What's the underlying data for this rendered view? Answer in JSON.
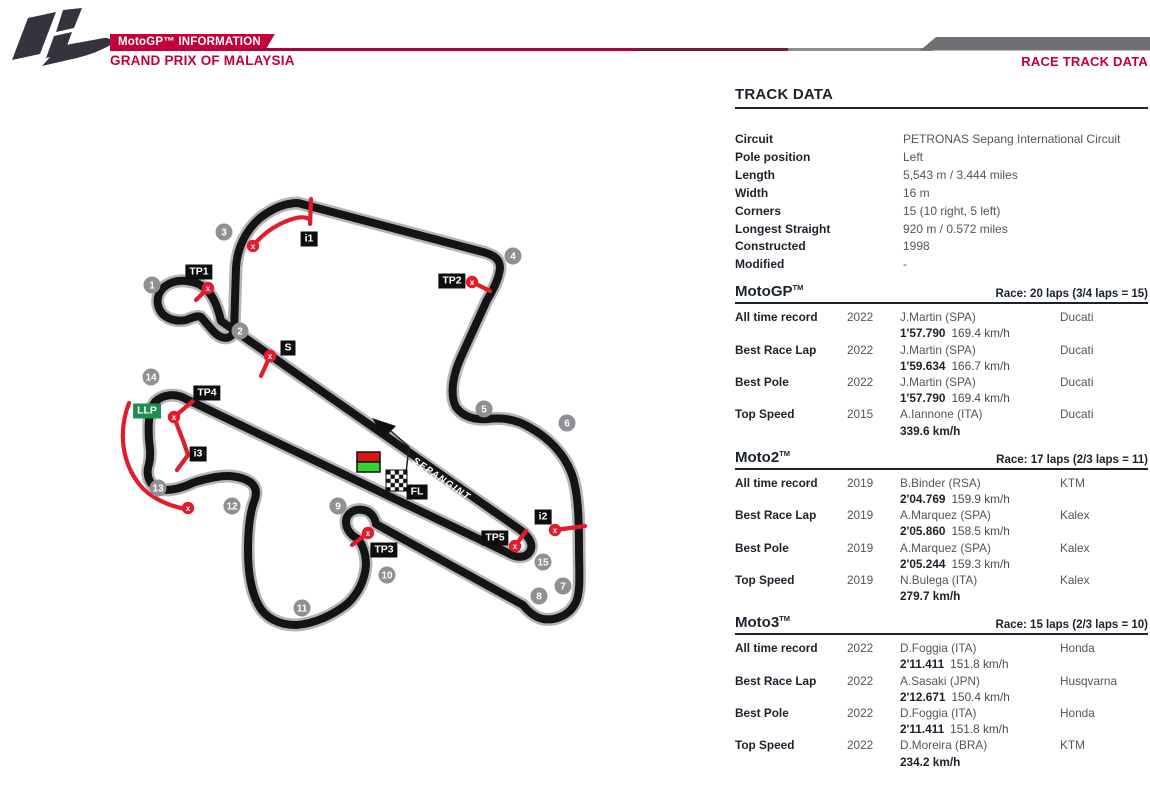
{
  "header": {
    "brand": "MotoGP™ INFORMATION",
    "subtitle": "GRAND PRIX OF MALAYSIA",
    "page_title": "RACE TRACK DATA",
    "accent_color": "#c2003c"
  },
  "track_data": {
    "title": "TRACK DATA",
    "rows": [
      {
        "label": "Circuit",
        "value": "PETRONAS Sepang International Circuit"
      },
      {
        "label": "Pole position",
        "value": "Left"
      },
      {
        "label": "Length",
        "value": "5,543 m / 3.444 miles"
      },
      {
        "label": "Width",
        "value": "16 m"
      },
      {
        "label": "Corners",
        "value": "15 (10 right, 5 left)"
      },
      {
        "label": "Longest Straight",
        "value": "920 m / 0.572 miles"
      },
      {
        "label": "Constructed",
        "value": "1998"
      },
      {
        "label": "Modified",
        "value": "-"
      }
    ]
  },
  "classes": [
    {
      "name": "MotoGP",
      "trademark": "TM",
      "race_info": "Race: 20 laps (3/4 laps = 15)",
      "records": [
        {
          "label": "All time record",
          "year": "2022",
          "rider": "J.Martin (SPA)",
          "bike": "Ducati",
          "time": "1'57.790",
          "speed": "169.4 km/h"
        },
        {
          "label": "Best Race Lap",
          "year": "2022",
          "rider": "J.Martin (SPA)",
          "bike": "Ducati",
          "time": "1'59.634",
          "speed": "166.7 km/h"
        },
        {
          "label": "Best Pole",
          "year": "2022",
          "rider": "J.Martin (SPA)",
          "bike": "Ducati",
          "time": "1'57.790",
          "speed": "169.4 km/h"
        },
        {
          "label": "Top Speed",
          "year": "2015",
          "rider": "A.Iannone (ITA)",
          "bike": "Ducati",
          "time": "",
          "speed": "339.6 km/h"
        }
      ]
    },
    {
      "name": "Moto2",
      "trademark": "TM",
      "race_info": "Race: 17 laps (2/3 laps = 11)",
      "records": [
        {
          "label": "All time record",
          "year": "2019",
          "rider": "B.Binder (RSA)",
          "bike": "KTM",
          "time": "2'04.769",
          "speed": "159.9 km/h"
        },
        {
          "label": "Best Race Lap",
          "year": "2019",
          "rider": "A.Marquez (SPA)",
          "bike": "Kalex",
          "time": "2'05.860",
          "speed": "158.5 km/h"
        },
        {
          "label": "Best Pole",
          "year": "2019",
          "rider": "A.Marquez (SPA)",
          "bike": "Kalex",
          "time": "2'05.244",
          "speed": "159.3 km/h"
        },
        {
          "label": "Top Speed",
          "year": "2019",
          "rider": "N.Bulega (ITA)",
          "bike": "Kalex",
          "time": "",
          "speed": "279.7 km/h"
        }
      ]
    },
    {
      "name": "Moto3",
      "trademark": "TM",
      "race_info": "Race: 15 laps (2/3 laps = 10)",
      "records": [
        {
          "label": "All time record",
          "year": "2022",
          "rider": "D.Foggia (ITA)",
          "bike": "Honda",
          "time": "2'11.411",
          "speed": "151.8 km/h"
        },
        {
          "label": "Best Race Lap",
          "year": "2022",
          "rider": "A.Sasaki (JPN)",
          "bike": "Husqvarna",
          "time": "2'12.671",
          "speed": "150.4 km/h"
        },
        {
          "label": "Best Pole",
          "year": "2022",
          "rider": "D.Foggia (ITA)",
          "bike": "Honda",
          "time": "2'11.411",
          "speed": "151.8 km/h"
        },
        {
          "label": "Top Speed",
          "year": "2022",
          "rider": "D.Moreira (BRA)",
          "bike": "KTM",
          "time": "",
          "speed": "234.2 km/h"
        }
      ]
    }
  ],
  "map": {
    "straight_text": "SEPANGINT",
    "track_color": "#141414",
    "sector_color": "#e31c2d",
    "turn_circle_color": "#8f9093",
    "llp_color": "#1f8e53",
    "turns": [
      {
        "n": "1",
        "x": 152,
        "y": 285
      },
      {
        "n": "2",
        "x": 240,
        "y": 331
      },
      {
        "n": "3",
        "x": 224,
        "y": 232
      },
      {
        "n": "4",
        "x": 513,
        "y": 256
      },
      {
        "n": "5",
        "x": 484,
        "y": 409
      },
      {
        "n": "6",
        "x": 567,
        "y": 423
      },
      {
        "n": "7",
        "x": 563,
        "y": 586
      },
      {
        "n": "8",
        "x": 539,
        "y": 596
      },
      {
        "n": "9",
        "x": 338,
        "y": 506
      },
      {
        "n": "10",
        "x": 387,
        "y": 575
      },
      {
        "n": "11",
        "x": 302,
        "y": 608
      },
      {
        "n": "12",
        "x": 232,
        "y": 506
      },
      {
        "n": "13",
        "x": 158,
        "y": 488
      },
      {
        "n": "14",
        "x": 151,
        "y": 377
      },
      {
        "n": "15",
        "x": 543,
        "y": 562
      }
    ],
    "boxes": [
      {
        "t": "TP1",
        "x": 199,
        "y": 272
      },
      {
        "t": "TP2",
        "x": 452,
        "y": 281
      },
      {
        "t": "TP3",
        "x": 384,
        "y": 550
      },
      {
        "t": "TP4",
        "x": 207,
        "y": 393
      },
      {
        "t": "TP5",
        "x": 495,
        "y": 538
      },
      {
        "t": "i1",
        "x": 309,
        "y": 239
      },
      {
        "t": "i2",
        "x": 543,
        "y": 517
      },
      {
        "t": "i3",
        "x": 198,
        "y": 454
      },
      {
        "t": "S",
        "x": 288,
        "y": 348
      },
      {
        "t": "FL",
        "x": 417,
        "y": 492
      }
    ],
    "llp": {
      "t": "LLP",
      "x": 147,
      "y": 411
    },
    "xmarks": [
      {
        "x": 253,
        "y": 246
      },
      {
        "x": 208,
        "y": 288
      },
      {
        "x": 472,
        "y": 282
      },
      {
        "x": 270,
        "y": 356
      },
      {
        "x": 174,
        "y": 417
      },
      {
        "x": 188,
        "y": 508
      },
      {
        "x": 368,
        "y": 533
      },
      {
        "x": 515,
        "y": 546
      },
      {
        "x": 555,
        "y": 530
      }
    ]
  }
}
